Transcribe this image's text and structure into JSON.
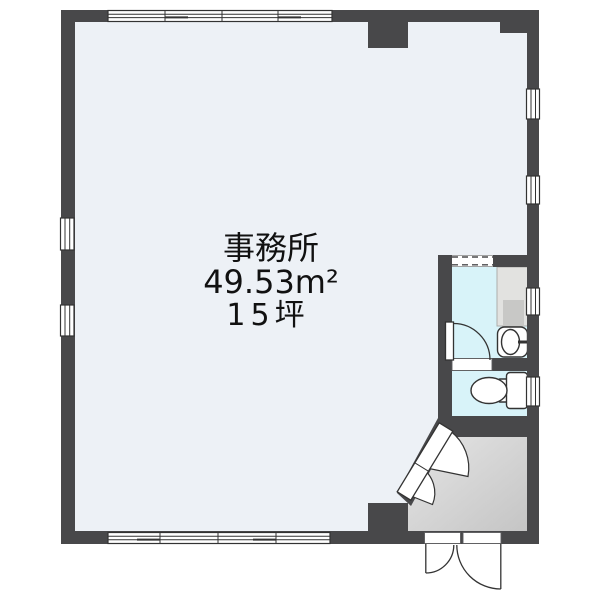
{
  "colors": {
    "wall": "#48484a",
    "floor-office": "#edf1f6",
    "floor-wet": "#d8f3f9",
    "vestibule-light": "#e6e6e6",
    "vestibule-dark": "#c4c4c4",
    "counter": "#e2e2e0",
    "sink": "#c8c8c6",
    "line": "#333333",
    "text": "#111111"
  },
  "room": {
    "name": "事務所",
    "area_sqm": "49.53m²",
    "area_tsubo": "15坪"
  },
  "features": [
    "sliding-window",
    "single-door",
    "entrance-double-door",
    "diagonal-double-door",
    "dashed-opening",
    "kitchen-counter",
    "sink",
    "wash-basin",
    "toilet",
    "vestibule",
    "pillar"
  ]
}
